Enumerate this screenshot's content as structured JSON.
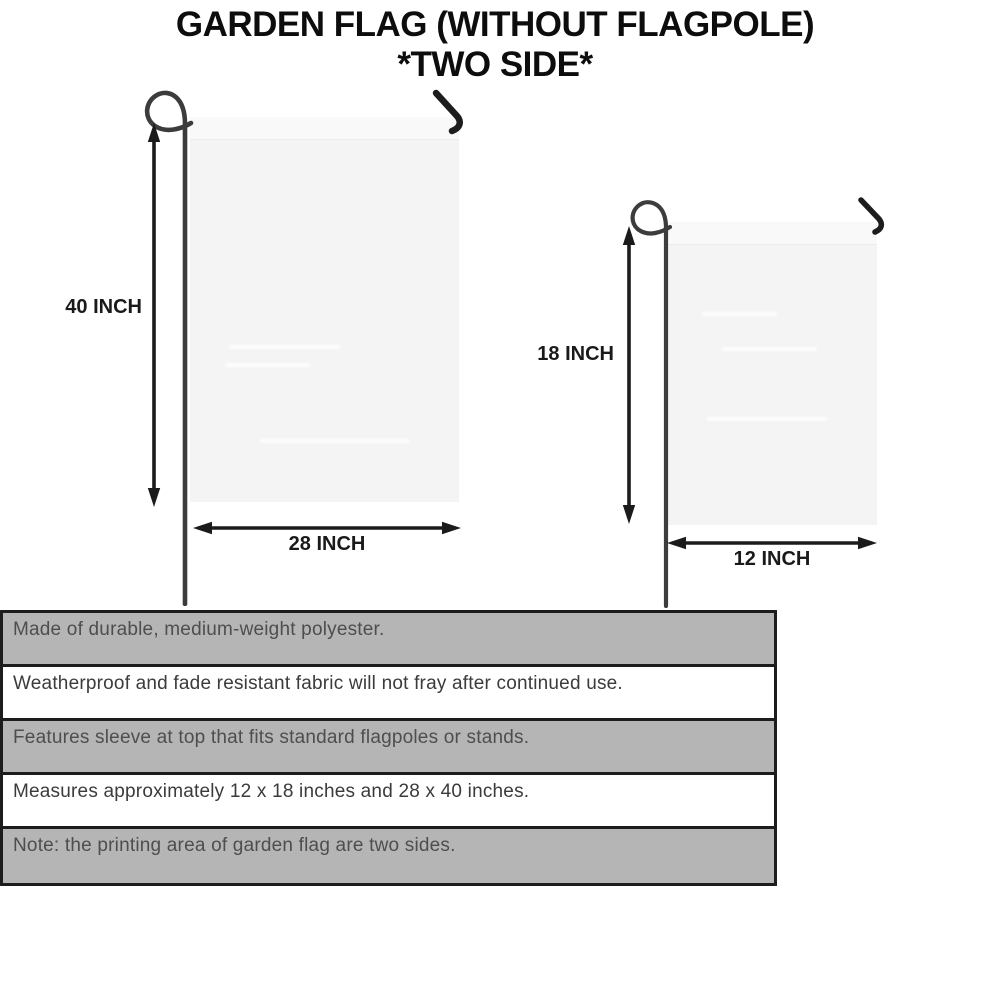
{
  "title": {
    "line1": "GARDEN FLAG (WITHOUT FLAGPOLE)",
    "line2": "*TWO SIDE*"
  },
  "diagram": {
    "large_flag": {
      "height_label": "40 INCH",
      "width_label": "28 INCH"
    },
    "small_flag": {
      "height_label": "18 INCH",
      "width_label": "12 INCH"
    }
  },
  "features": [
    "Made of durable, medium-weight polyester.",
    "Weatherproof and fade resistant fabric will not fray after continued use.",
    "Features sleeve at top that fits standard flagpoles or stands.",
    "Measures approximately 12 x 18 inches and 28 x 40 inches.",
    "Note: the printing area of garden flag are two sides."
  ],
  "colors": {
    "row_gray": "#b5b5b5",
    "row_white": "#ffffff",
    "table_border": "#1c1c1c",
    "flag_fill": "#f4f4f5",
    "pole_gray": "#3c3c3c",
    "arrow_black": "#1b1b1b",
    "title_text": "#0d0d0d",
    "feature_text_gray_row": "#4e4e4e",
    "feature_text_white_row": "#3b3b3b"
  }
}
